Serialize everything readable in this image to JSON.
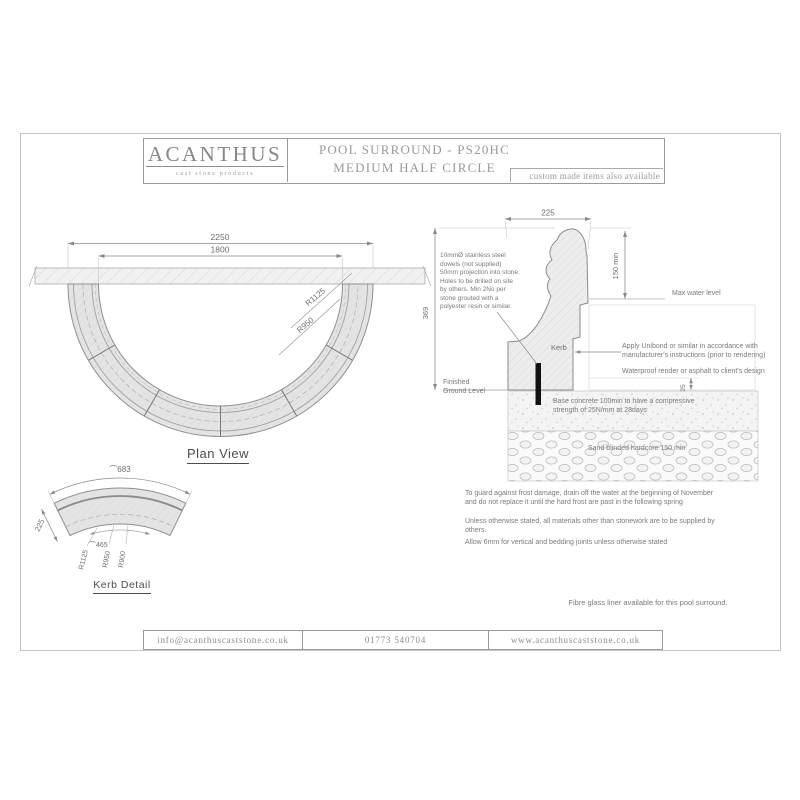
{
  "header": {
    "brand": "ACANTHUS",
    "brand_tagline": "cast stone products",
    "title_line1": "POOL SURROUND - PS20HC",
    "title_line2": "MEDIUM HALF CIRCLE",
    "custom_note": "custom made items also available"
  },
  "plan_view": {
    "caption": "Plan View",
    "dim_overall": "2250",
    "dim_inner": "1800",
    "radius_outer_label": "R1125",
    "radius_mid_label": "R950"
  },
  "kerb_detail": {
    "caption": "Kerb Detail",
    "arc_outer_label": "⌒683",
    "arc_inner_label": "⌒465",
    "width_label": "225",
    "radius_labels": [
      "R1125",
      "R950",
      "R900"
    ]
  },
  "section": {
    "dim_width": "225",
    "dim_height": "369",
    "dim_water": "150 min",
    "dim_render": "25",
    "kerb_label": "Kerb",
    "max_water_label": "Max water level",
    "ground_label": "Finished Ground Level",
    "dowel_note": "10mmØ stainless steel dowels (not supplied) 50mm projection into stone. Holes to be drilled on site by others. Min 2No per stone grouted with a polyester resin or similar.",
    "unibond_note": "Apply Unibond or similar in accordance with manufacturer's instructions (prior to rendering)",
    "render_note": "Waterproof render or asphalt to client's design",
    "concrete_note": "Base concrete 100min to have a compressive strength of 25N/mm at 28days",
    "hardcore_note": "Sand blinded hardcore 150 min"
  },
  "notes": {
    "frost": "To guard against frost damage, drain off the water at the beginning of November and do not replace it until the hard frost are past in the following spring",
    "materials": "Unless otherwise stated, all materials other than stonework are to be supplied by others.",
    "joints": "Allow 6mm for vertical and bedding joints unless otherwise stated",
    "liner": "Fibre glass liner available for this pool surround."
  },
  "footer": {
    "email": "info@acanthuscaststone.co.uk",
    "phone": "01773 540704",
    "website": "www.acanthuscaststone.co.uk"
  },
  "colors": {
    "line": "#9a9a9a",
    "light_line": "#c0c0c0",
    "text": "#7a7a7a",
    "stone_fill": "#e4e4e4",
    "dowel": "#111111"
  }
}
